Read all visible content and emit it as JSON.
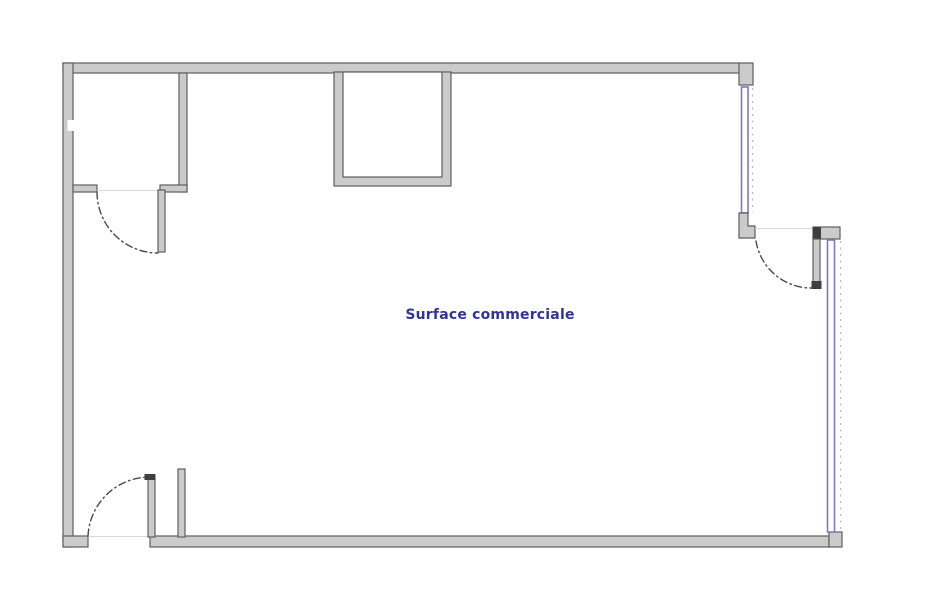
{
  "plan": {
    "label": "Surface commerciale"
  },
  "colors": {
    "background": "#ffffff",
    "wall_fill": "#cbcbcb",
    "wall_stroke": "#5e5e5e",
    "wall_dark": "#3f3f3f",
    "window_blue": "#7a7ac6",
    "dashed_gray": "#b9b9b9",
    "threshold_gray": "#d8d8d8",
    "door_arc": "#4a4a4a",
    "label_text": "#32329b"
  }
}
